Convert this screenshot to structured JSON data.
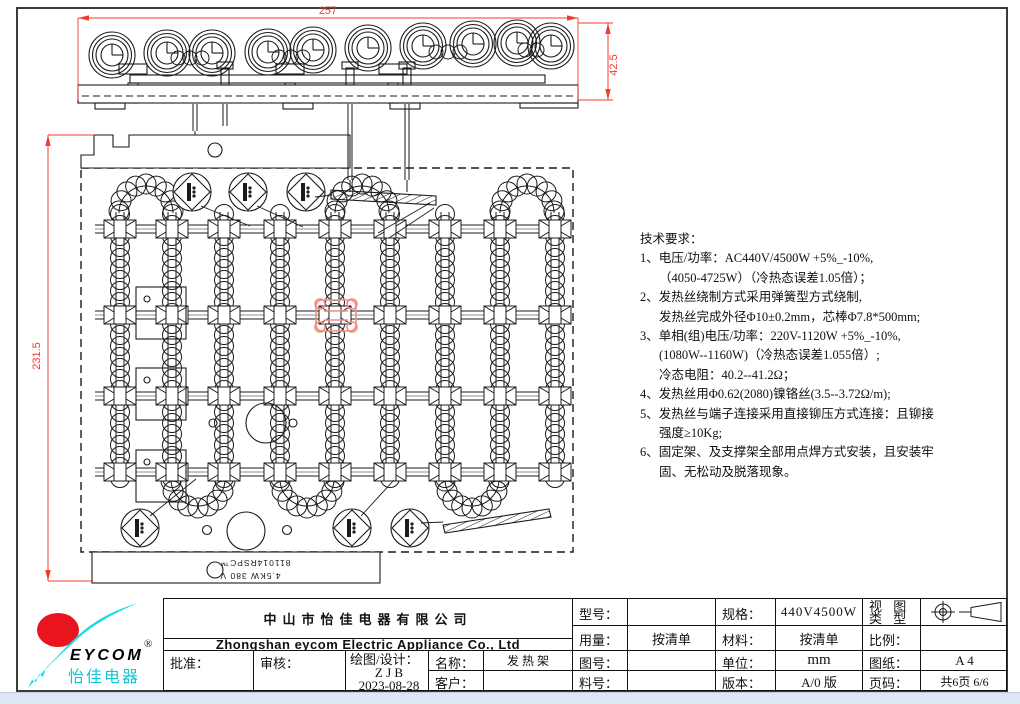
{
  "dims": {
    "d257": "257",
    "d425": "42.5",
    "d2315": "231.5"
  },
  "stamp": {
    "line1": "811014RSPC™",
    "line2": "4.5KW  380 V"
  },
  "tech": {
    "lines": [
      "技术要求：",
      "1、电压/功率：AC440V/4500W +5%_-10%,",
      "（4050-4725W）（冷热态误差1.05倍）；",
      "2、发热丝绕制方式采用弹簧型方式绕制,",
      "发热丝完成外径Φ10±0.2mm，芯棒Φ7.8*500mm;",
      "3、单相(组)电压/功率：220V-1120W +5%_-10%,",
      "(1080W--1160W)（冷热态误差1.055倍）;",
      "冷态电阻：40.2--41.2Ω；",
      "4、发热丝用Φ0.62(2080)镍铬丝(3.5--3.72Ω/m);",
      "5、发热丝与端子连接采用直接铆压方式连接：且铆接",
      "强度≥10Kg;",
      "6、固定架、及支撑架全部用点焊方式安装，且安装牢",
      "固、无松动及脱落现象。"
    ]
  },
  "tb": {
    "company_cn": "中山市怡佳电器有限公司",
    "company_en": "Zhongshan eycom Electric Appliance Co., Ltd",
    "approve": "批准：",
    "review": "审核：",
    "draw_label": "绘图/设计：",
    "draw_name": "Z J B",
    "draw_date": "2023-08-28",
    "name_label": "名称：",
    "name_value": "发 热 架",
    "customer_label": "客户：",
    "model_label": "型号：",
    "spec_label": "规格：",
    "spec_value": "440V4500W",
    "view_line1": "视  图",
    "view_line2": "类  型",
    "usage_label": "用量：",
    "usage_value": "按清单",
    "material_label": "材料：",
    "material_value": "按清单",
    "scale_label": "比例：",
    "drawno_label": "图号：",
    "unit_label": "单位：",
    "unit_value": "mm",
    "paper_label": "图纸：",
    "paper_value": "A  4",
    "partno_label": "料号：",
    "version_label": "版本：",
    "version_value": "A/0 版",
    "pageno_label": "页码：",
    "pageno_value": "共6页 6/6"
  },
  "logo": {
    "brand": "EYCOM",
    "brand_cn": "怡佳电器",
    "reg": "®",
    "cyan": "#15dde8",
    "red": "#e8141e"
  },
  "colors": {
    "line": "#1b1b1b",
    "dim_red": "#f23c2e",
    "highlight": "#ef8e82"
  }
}
